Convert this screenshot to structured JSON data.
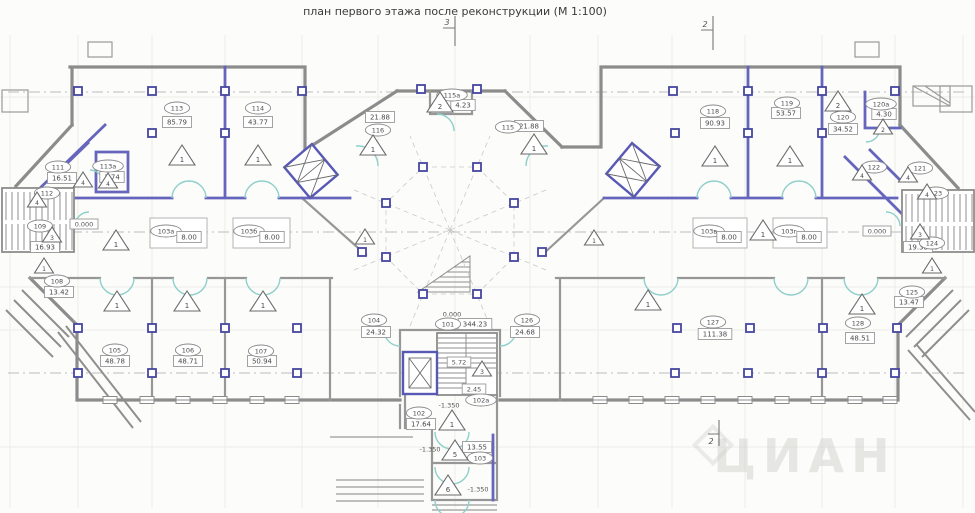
{
  "title": "план первого этажа после реконструкции (М 1:100)",
  "watermark": {
    "text": "ЦИАН"
  },
  "sections": [
    {
      "label": "3"
    },
    {
      "label": "2"
    },
    {
      "label": "2"
    }
  ],
  "levels": [
    {
      "text": "0.000",
      "x": 452,
      "y": 314,
      "boxed": false
    },
    {
      "text": "0.000",
      "x": 84,
      "y": 224,
      "boxed": true
    },
    {
      "text": "0.000",
      "x": 877,
      "y": 231,
      "boxed": true
    },
    {
      "text": "-1.350",
      "x": 449,
      "y": 405,
      "boxed": false
    },
    {
      "text": "-1.350",
      "x": 430,
      "y": 449,
      "boxed": false
    },
    {
      "text": "-1.350",
      "x": 478,
      "y": 489,
      "boxed": false
    }
  ],
  "dimensions": [
    {
      "text": "5.72",
      "x": 459,
      "y": 362
    },
    {
      "text": "2.45",
      "x": 474,
      "y": 389
    }
  ],
  "rooms": [
    {
      "id": "113",
      "id_x": 177,
      "id_y": 108,
      "area": "85.79",
      "area_x": 177,
      "area_y": 122
    },
    {
      "id": "114",
      "id_x": 258,
      "id_y": 108,
      "area": "43.77",
      "area_x": 258,
      "area_y": 122
    },
    {
      "id": "111",
      "id_x": 58,
      "id_y": 167,
      "area": "16.51",
      "area_x": 62,
      "area_y": 178
    },
    {
      "id": "113а",
      "id_x": 108,
      "id_y": 166,
      "area": "1.74",
      "area_x": 112,
      "area_y": 177
    },
    {
      "id": "112",
      "id_x": 47,
      "id_y": 193,
      "area": null,
      "area_x": 0,
      "area_y": 0
    },
    {
      "id": "109",
      "id_x": 40,
      "id_y": 226,
      "area": "16.93",
      "area_x": 45,
      "area_y": 247
    },
    {
      "id": "108",
      "id_x": 57,
      "id_y": 281,
      "area": "13.42",
      "area_x": 59,
      "area_y": 292
    },
    {
      "id": "116",
      "id_x": 378,
      "id_y": 130,
      "area": "21.88",
      "area_x": 380,
      "area_y": 117
    },
    {
      "id": "115",
      "id_x": 508,
      "id_y": 127,
      "area": "21.88",
      "area_x": 529,
      "area_y": 126
    },
    {
      "id": "115а",
      "id_x": 452,
      "id_y": 95,
      "area": "4.23",
      "area_x": 463,
      "area_y": 105
    },
    {
      "id": "101",
      "id_x": 448,
      "id_y": 324,
      "area": "344.23",
      "area_x": 475,
      "area_y": 324
    },
    {
      "id": "104",
      "id_x": 374,
      "id_y": 320,
      "area": "24.32",
      "area_x": 376,
      "area_y": 332
    },
    {
      "id": "126",
      "id_x": 527,
      "id_y": 320,
      "area": "24.68",
      "area_x": 525,
      "area_y": 332
    },
    {
      "id": "102",
      "id_x": 419,
      "id_y": 413,
      "area": "17.64",
      "area_x": 421,
      "area_y": 424
    },
    {
      "id": "102а",
      "id_x": 481,
      "id_y": 400,
      "area": null,
      "area_x": 0,
      "area_y": 0
    },
    {
      "id": "103",
      "id_x": 480,
      "id_y": 458,
      "area": "13.55",
      "area_x": 477,
      "area_y": 447
    },
    {
      "id": "105",
      "id_x": 115,
      "id_y": 350,
      "area": "48.78",
      "area_x": 115,
      "area_y": 361
    },
    {
      "id": "106",
      "id_x": 188,
      "id_y": 350,
      "area": "48.71",
      "area_x": 188,
      "area_y": 361
    },
    {
      "id": "107",
      "id_x": 261,
      "id_y": 351,
      "area": "50.94",
      "area_x": 262,
      "area_y": 361
    },
    {
      "id": "118",
      "id_x": 713,
      "id_y": 111,
      "area": "90.93",
      "area_x": 715,
      "area_y": 123
    },
    {
      "id": "119",
      "id_x": 787,
      "id_y": 103,
      "area": "53.57",
      "area_x": 786,
      "area_y": 113
    },
    {
      "id": "120",
      "id_x": 843,
      "id_y": 117,
      "area": "34.52",
      "area_x": 843,
      "area_y": 129
    },
    {
      "id": "120а",
      "id_x": 881,
      "id_y": 104,
      "area": "4.30",
      "area_x": 884,
      "area_y": 114
    },
    {
      "id": "121",
      "id_x": 920,
      "id_y": 168,
      "area": null,
      "area_x": 0,
      "area_y": 0
    },
    {
      "id": "122",
      "id_x": 874,
      "id_y": 167,
      "area": null,
      "area_x": 0,
      "area_y": 0
    },
    {
      "id": "123",
      "id_x": 936,
      "id_y": 193,
      "area": null,
      "area_x": 0,
      "area_y": 0
    },
    {
      "id": "124",
      "id_x": 932,
      "id_y": 243,
      "area": "19.38",
      "area_x": 918,
      "area_y": 247
    },
    {
      "id": "125",
      "id_x": 912,
      "id_y": 292,
      "area": "13.47",
      "area_x": 909,
      "area_y": 302
    },
    {
      "id": "127",
      "id_x": 713,
      "id_y": 322,
      "area": "111.38",
      "area_x": 715,
      "area_y": 334
    },
    {
      "id": "128",
      "id_x": 858,
      "id_y": 323,
      "area": "48.51",
      "area_x": 860,
      "area_y": 338
    }
  ],
  "zones": [
    {
      "id": "103а",
      "area": "8.00",
      "x": 150,
      "y": 218,
      "w": 57,
      "h": 30
    },
    {
      "id": "103б",
      "area": "8.00",
      "x": 233,
      "y": 218,
      "w": 57,
      "h": 30
    },
    {
      "id": "103в",
      "area": "8.00",
      "x": 693,
      "y": 218,
      "w": 54,
      "h": 30
    },
    {
      "id": "103г",
      "area": "8.00",
      "x": 773,
      "y": 218,
      "w": 54,
      "h": 30
    }
  ],
  "markers": [
    {
      "n": "1",
      "x": 182,
      "y": 157,
      "size": "b"
    },
    {
      "n": "1",
      "x": 258,
      "y": 157,
      "size": "b"
    },
    {
      "n": "1",
      "x": 373,
      "y": 147,
      "size": "b"
    },
    {
      "n": "1",
      "x": 534,
      "y": 146,
      "size": "b"
    },
    {
      "n": "1",
      "x": 715,
      "y": 158,
      "size": "b"
    },
    {
      "n": "1",
      "x": 790,
      "y": 158,
      "size": "b"
    },
    {
      "n": "1",
      "x": 117,
      "y": 303,
      "size": "b"
    },
    {
      "n": "1",
      "x": 187,
      "y": 303,
      "size": "b"
    },
    {
      "n": "1",
      "x": 263,
      "y": 303,
      "size": "b"
    },
    {
      "n": "1",
      "x": 648,
      "y": 302,
      "size": "b"
    },
    {
      "n": "1",
      "x": 862,
      "y": 306,
      "size": "b"
    },
    {
      "n": "1",
      "x": 116,
      "y": 242,
      "size": "b"
    },
    {
      "n": "1",
      "x": 763,
      "y": 232,
      "size": "b"
    },
    {
      "n": "1",
      "x": 44,
      "y": 267,
      "size": "s"
    },
    {
      "n": "1",
      "x": 932,
      "y": 267,
      "size": "s"
    },
    {
      "n": "1",
      "x": 452,
      "y": 422,
      "size": "b"
    },
    {
      "n": "1",
      "x": 365,
      "y": 238,
      "size": "s"
    },
    {
      "n": "1",
      "x": 594,
      "y": 239,
      "size": "s"
    },
    {
      "n": "2",
      "x": 440,
      "y": 104,
      "size": "b"
    },
    {
      "n": "2",
      "x": 838,
      "y": 103,
      "size": "b"
    },
    {
      "n": "2",
      "x": 883,
      "y": 128,
      "size": "s"
    },
    {
      "n": "3",
      "x": 52,
      "y": 236,
      "size": "s"
    },
    {
      "n": "3",
      "x": 920,
      "y": 233,
      "size": "s"
    },
    {
      "n": "3",
      "x": 482,
      "y": 370,
      "size": "s"
    },
    {
      "n": "4",
      "x": 83,
      "y": 181,
      "size": "s"
    },
    {
      "n": "4",
      "x": 108,
      "y": 182,
      "size": "s"
    },
    {
      "n": "4",
      "x": 37,
      "y": 201,
      "size": "s"
    },
    {
      "n": "4",
      "x": 862,
      "y": 174,
      "size": "s"
    },
    {
      "n": "4",
      "x": 908,
      "y": 176,
      "size": "s"
    },
    {
      "n": "4",
      "x": 927,
      "y": 193,
      "size": "s"
    },
    {
      "n": "5",
      "x": 455,
      "y": 452,
      "size": "b"
    },
    {
      "n": "6",
      "x": 448,
      "y": 487,
      "size": "b"
    }
  ]
}
